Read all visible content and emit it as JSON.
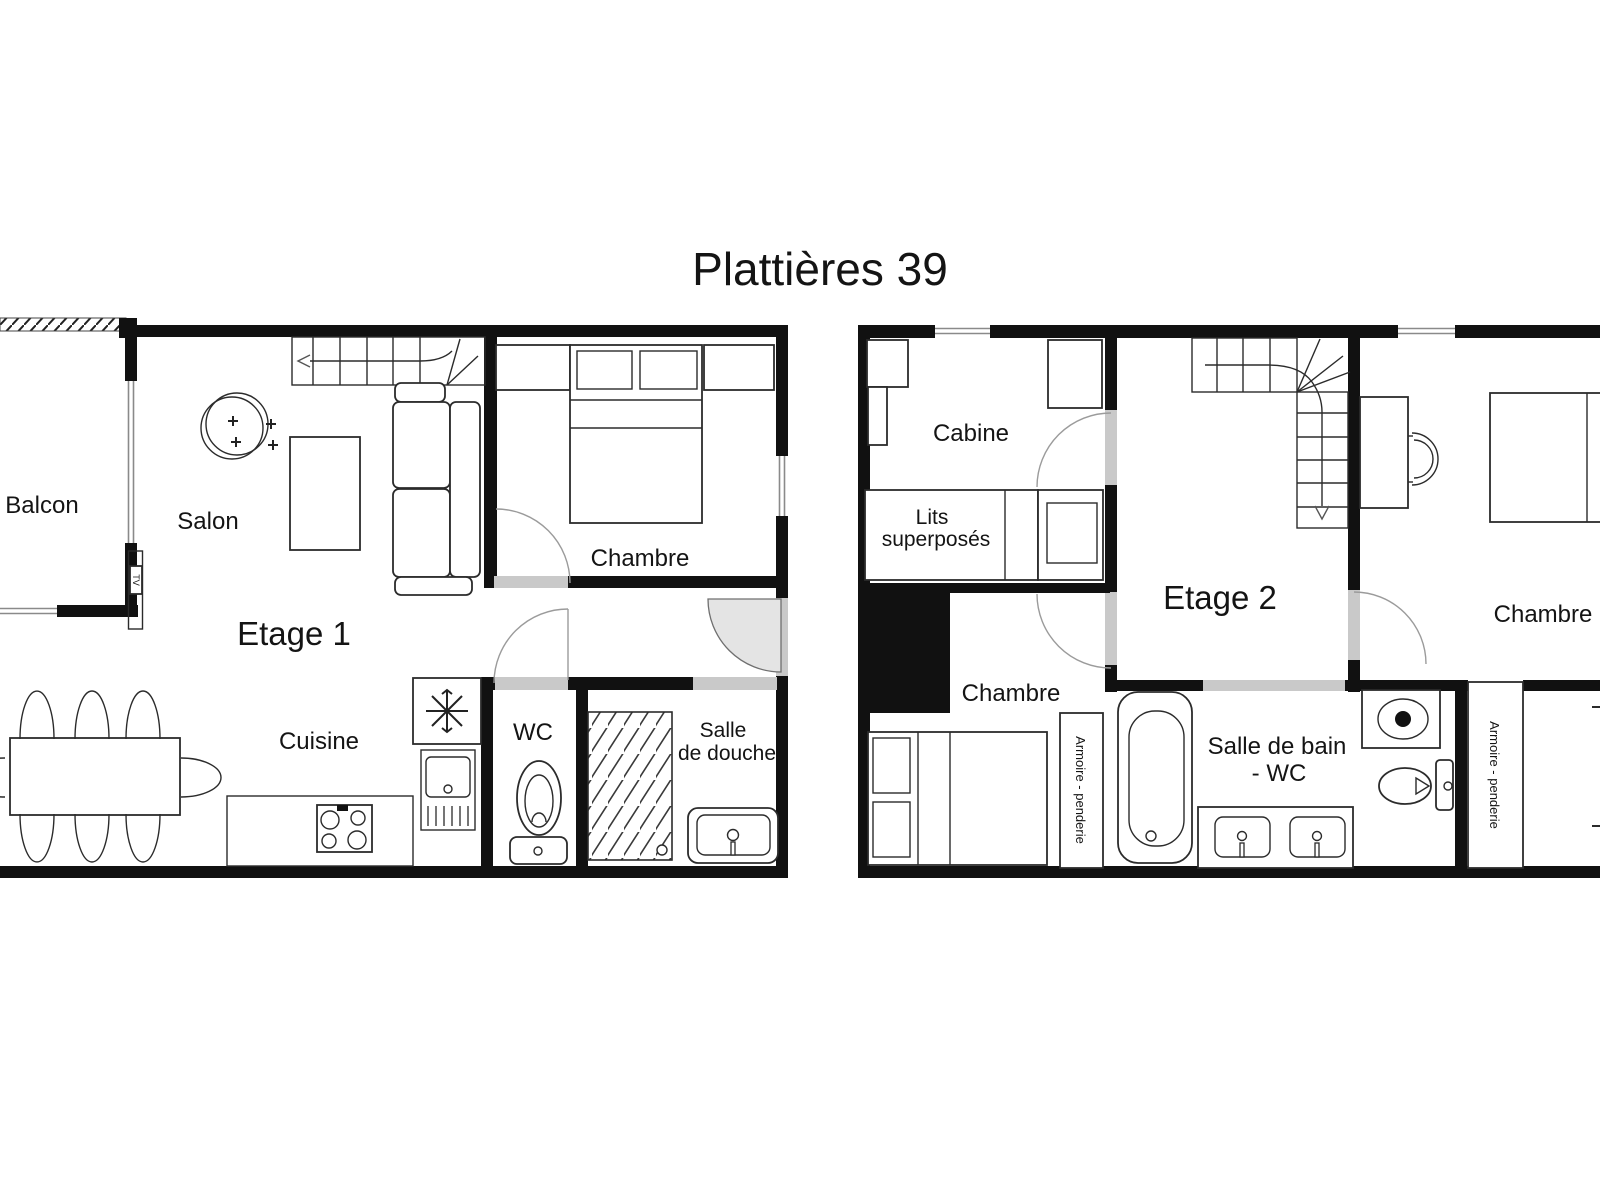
{
  "title": "Plattières 39",
  "floor1": {
    "label": "Etage 1",
    "rooms": {
      "balcon": "Balcon",
      "salon": "Salon",
      "chambre": "Chambre",
      "cuisine": "Cuisine",
      "wc": "WC",
      "douche_line1": "Salle",
      "douche_line2": "de douche"
    },
    "tv": "TV"
  },
  "floor2": {
    "label": "Etage 2",
    "rooms": {
      "cabine": "Cabine",
      "lits_line1": "Lits",
      "lits_line2": "superposés",
      "chambre_left": "Chambre",
      "chambre_right": "Chambre",
      "bain_line1": "Salle de bain",
      "bain_line2": "- WC",
      "armoire_left": "Armoire - penderie",
      "armoire_right": "Armoire - penderie"
    }
  },
  "colors": {
    "wall": "#111111",
    "door_gap": "#c9c9c9",
    "door_arc": "#9b9b9b",
    "entry_sector": "#e4e4e4",
    "background": "#ffffff",
    "text": "#141414"
  }
}
